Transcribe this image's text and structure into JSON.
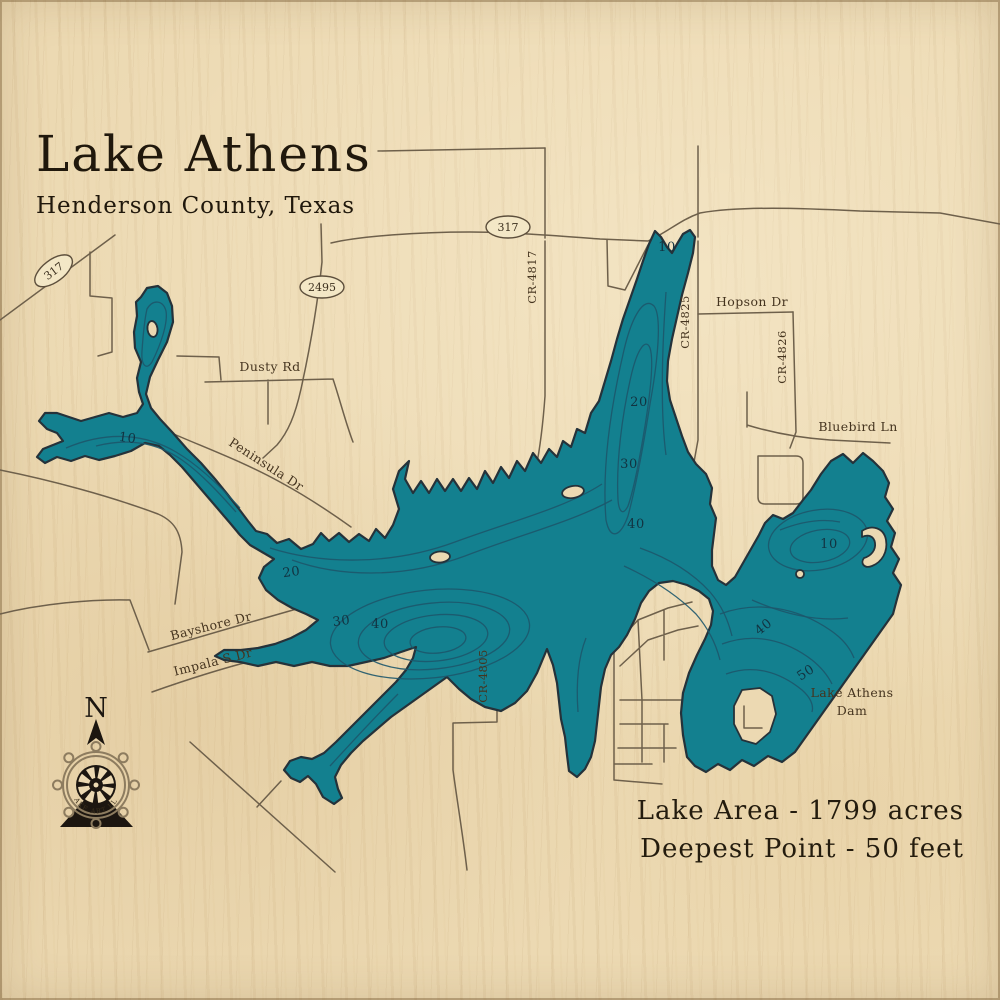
{
  "title": {
    "main": "Lake Athens",
    "subtitle": "Henderson County, Texas"
  },
  "stats": {
    "area": "Lake Area - 1799 acres",
    "depth": "Deepest Point - 50 feet"
  },
  "compass": {
    "letter": "N",
    "brand": "LAKE ART LLC"
  },
  "colors": {
    "wood": "#ecd9b2",
    "lake": "#13808f",
    "shoreline": "#25323a",
    "contour": "#1d566b",
    "road": "#6e604b",
    "label": "#45341f",
    "depth_label": "#123341",
    "ink": "#20180c"
  },
  "road_shields": [
    {
      "text": "317",
      "x": 56,
      "y": 274,
      "rot": -37
    },
    {
      "text": "317",
      "x": 508,
      "y": 231,
      "rot": 0
    },
    {
      "text": "2495",
      "x": 322,
      "y": 291,
      "rot": 0
    }
  ],
  "road_labels": [
    {
      "text": "Dusty Rd",
      "x": 270,
      "y": 371,
      "rot": 0
    },
    {
      "text": "Hopson Dr",
      "x": 752,
      "y": 306,
      "rot": 0
    },
    {
      "text": "Bluebird Ln",
      "x": 858,
      "y": 431,
      "rot": 0
    },
    {
      "text": "Peninsula Dr",
      "x": 264,
      "y": 468,
      "rot": 33
    },
    {
      "text": "Bayshore Dr",
      "x": 212,
      "y": 630,
      "rot": -14
    },
    {
      "text": "Impala S Dr",
      "x": 214,
      "y": 666,
      "rot": -14
    },
    {
      "text": "CR-4817",
      "x": 536,
      "y": 277,
      "rot": -90,
      "cls": "small"
    },
    {
      "text": "CR-4825",
      "x": 689,
      "y": 322,
      "rot": -90,
      "cls": "small"
    },
    {
      "text": "CR-4826",
      "x": 786,
      "y": 357,
      "rot": -90,
      "cls": "small"
    },
    {
      "text": "CR-4805",
      "x": 487,
      "y": 676,
      "rot": -90,
      "cls": "small"
    },
    {
      "text": "Lake Athens",
      "x": 852,
      "y": 697,
      "rot": 0
    },
    {
      "text": "Dam",
      "x": 852,
      "y": 715,
      "rot": 0
    }
  ],
  "depth_labels": [
    {
      "text": "10",
      "x": 127,
      "y": 442,
      "rot": 8
    },
    {
      "text": "10",
      "x": 667,
      "y": 251,
      "rot": 0
    },
    {
      "text": "20",
      "x": 639,
      "y": 406,
      "rot": 0
    },
    {
      "text": "30",
      "x": 629,
      "y": 468,
      "rot": 0
    },
    {
      "text": "40",
      "x": 636,
      "y": 528,
      "rot": 0
    },
    {
      "text": "20",
      "x": 292,
      "y": 576,
      "rot": -8
    },
    {
      "text": "30",
      "x": 342,
      "y": 625,
      "rot": -8
    },
    {
      "text": "40",
      "x": 380,
      "y": 628,
      "rot": 0
    },
    {
      "text": "10",
      "x": 829,
      "y": 548,
      "rot": 0
    },
    {
      "text": "40",
      "x": 766,
      "y": 630,
      "rot": -38
    },
    {
      "text": "50",
      "x": 808,
      "y": 676,
      "rot": -33
    }
  ]
}
